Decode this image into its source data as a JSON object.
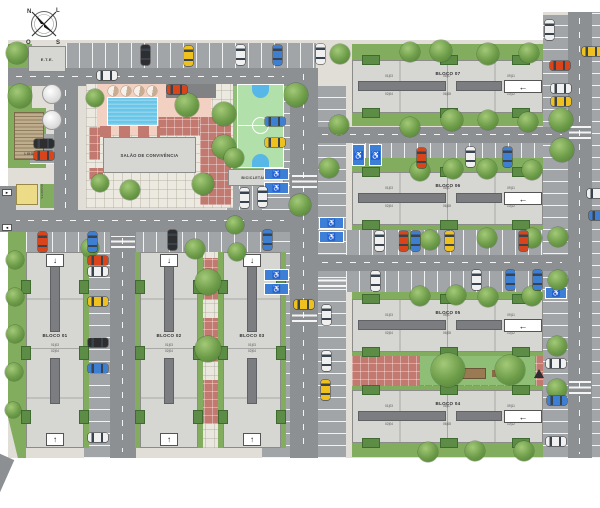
{
  "compass": {
    "n": "N",
    "e": "L",
    "s": "S",
    "w": "O"
  },
  "facilities": {
    "ete_label": "E.T.E.",
    "lixo_label": "LIXO",
    "guarita_label": "GUARITA",
    "salao_label": "SALÃO DE CONVIVÊNCIA",
    "bicicletario_label": "BICICLETÁRIO",
    "entry_arrow_in": "►",
    "entry_arrow_out": "◄"
  },
  "icons": {
    "accessible": "♿",
    "arrow_left": "←",
    "arrow_up": "↑",
    "arrow_down": "↓"
  },
  "blocks": [
    {
      "id": "bloco-01",
      "label": "BLOCO 01",
      "type": "vertical",
      "x": 26,
      "y": 252,
      "units_top": "01|03",
      "units_bottom": "02|04"
    },
    {
      "id": "bloco-02",
      "label": "BLOCO 02",
      "type": "vertical",
      "x": 140,
      "y": 252,
      "units_top": "01|03",
      "units_bottom": "02|04"
    },
    {
      "id": "bloco-03",
      "label": "BLOCO 03",
      "type": "vertical",
      "x": 223,
      "y": 252,
      "units_top": "01|03",
      "units_bottom": "02|04"
    },
    {
      "id": "bloco-07",
      "label": "BLOCO 07",
      "type": "horizontal",
      "x": 352,
      "y": 60,
      "gt": 16,
      "gb": 13,
      "units": {
        "lt": "01|03",
        "lb": "02|04",
        "mt": "05|07",
        "mb": "06|08",
        "rt": "09|11",
        "rb": "10|12"
      }
    },
    {
      "id": "bloco-06",
      "label": "BLOCO 06",
      "type": "horizontal",
      "x": 352,
      "y": 172,
      "gt": 14,
      "gb": 5,
      "units": {
        "lt": "01|03",
        "lb": "02|04",
        "mt": "05|07",
        "mb": "06|08",
        "rt": "09|11",
        "rb": "10|12"
      }
    },
    {
      "id": "bloco-05",
      "label": "BLOCO 05",
      "type": "horizontal",
      "x": 352,
      "y": 299,
      "gt": 7,
      "gb": 4,
      "units": {
        "lt": "01|03",
        "lb": "02|04",
        "mt": "05|07",
        "mb": "06|08",
        "rt": "09|11",
        "rb": "10|12"
      }
    },
    {
      "id": "bloco-04",
      "label": "BLOCO 04",
      "type": "horizontal",
      "x": 352,
      "y": 390,
      "gt": 4,
      "gb": 14,
      "units": {
        "lt": "01|03",
        "lb": "02|04",
        "mt": "05|07",
        "mb": "06|08",
        "rt": "09|11",
        "rb": "10|12"
      }
    }
  ],
  "cars": [
    [
      141,
      45,
      "v",
      "dark"
    ],
    [
      184,
      46,
      "v",
      "yellow"
    ],
    [
      236,
      45,
      "v",
      "white"
    ],
    [
      273,
      45,
      "v",
      "blue"
    ],
    [
      316,
      44,
      "v",
      "white"
    ],
    [
      97,
      71,
      "h",
      "white"
    ],
    [
      167,
      85,
      "h",
      "red"
    ],
    [
      34,
      139,
      "h",
      "dark"
    ],
    [
      34,
      151,
      "h",
      "red"
    ],
    [
      240,
      188,
      "v",
      "white"
    ],
    [
      258,
      187,
      "v",
      "white"
    ],
    [
      265,
      117,
      "h",
      "blue"
    ],
    [
      265,
      138,
      "h",
      "yellow"
    ],
    [
      294,
      300,
      "h",
      "yellow"
    ],
    [
      38,
      232,
      "v",
      "red"
    ],
    [
      88,
      232,
      "v",
      "blue"
    ],
    [
      168,
      230,
      "v",
      "dark"
    ],
    [
      263,
      230,
      "v",
      "blue"
    ],
    [
      88,
      256,
      "h",
      "red"
    ],
    [
      88,
      267,
      "h",
      "white"
    ],
    [
      88,
      297,
      "h",
      "yellow"
    ],
    [
      88,
      338,
      "h",
      "dark"
    ],
    [
      88,
      364,
      "h",
      "blue"
    ],
    [
      88,
      433,
      "h",
      "white"
    ],
    [
      417,
      148,
      "v",
      "red"
    ],
    [
      466,
      147,
      "v",
      "white"
    ],
    [
      503,
      147,
      "v",
      "blue"
    ],
    [
      375,
      231,
      "v",
      "white"
    ],
    [
      399,
      231,
      "v",
      "red"
    ],
    [
      411,
      231,
      "v",
      "blue"
    ],
    [
      445,
      231,
      "v",
      "yellow"
    ],
    [
      519,
      231,
      "v",
      "red"
    ],
    [
      371,
      271,
      "v",
      "white"
    ],
    [
      472,
      270,
      "v",
      "white"
    ],
    [
      506,
      270,
      "v",
      "blue"
    ],
    [
      533,
      270,
      "v",
      "blue"
    ],
    [
      322,
      305,
      "v",
      "white"
    ],
    [
      322,
      351,
      "v",
      "white"
    ],
    [
      321,
      380,
      "v",
      "yellow"
    ],
    [
      545,
      20,
      "v",
      "white"
    ],
    [
      582,
      47,
      "h",
      "yellow"
    ],
    [
      550,
      61,
      "h",
      "red"
    ],
    [
      551,
      84,
      "h",
      "white"
    ],
    [
      551,
      97,
      "h",
      "yellow"
    ],
    [
      546,
      359,
      "h",
      "white"
    ],
    [
      547,
      396,
      "h",
      "blue"
    ],
    [
      546,
      437,
      "h",
      "white"
    ],
    [
      587,
      189,
      "h",
      "white"
    ],
    [
      589,
      211,
      "h",
      "blue"
    ]
  ],
  "trees": [
    [
      17,
      53,
      11
    ],
    [
      20,
      96,
      12
    ],
    [
      15,
      260,
      9
    ],
    [
      15,
      297,
      9
    ],
    [
      15,
      334,
      9
    ],
    [
      14,
      372,
      9
    ],
    [
      13,
      410,
      8
    ],
    [
      95,
      98,
      9
    ],
    [
      100,
      183,
      9
    ],
    [
      130,
      190,
      10
    ],
    [
      90,
      248,
      9
    ],
    [
      187,
      105,
      12
    ],
    [
      224,
      114,
      12
    ],
    [
      224,
      147,
      12
    ],
    [
      203,
      184,
      11
    ],
    [
      296,
      95,
      12
    ],
    [
      234,
      158,
      10
    ],
    [
      300,
      205,
      11
    ],
    [
      235,
      225,
      9
    ],
    [
      195,
      249,
      10
    ],
    [
      237,
      252,
      9
    ],
    [
      339,
      125,
      10
    ],
    [
      329,
      168,
      10
    ],
    [
      340,
      54,
      10
    ],
    [
      410,
      52,
      10
    ],
    [
      441,
      51,
      11
    ],
    [
      488,
      54,
      11
    ],
    [
      529,
      53,
      10
    ],
    [
      410,
      127,
      10
    ],
    [
      452,
      120,
      11
    ],
    [
      488,
      120,
      10
    ],
    [
      528,
      122,
      10
    ],
    [
      420,
      171,
      10
    ],
    [
      453,
      169,
      10
    ],
    [
      487,
      169,
      10
    ],
    [
      532,
      170,
      10
    ],
    [
      409,
      240,
      9
    ],
    [
      430,
      240,
      10
    ],
    [
      487,
      238,
      10
    ],
    [
      532,
      238,
      10
    ],
    [
      420,
      296,
      10
    ],
    [
      456,
      295,
      10
    ],
    [
      488,
      297,
      10
    ],
    [
      532,
      296,
      10
    ],
    [
      448,
      370,
      17
    ],
    [
      510,
      370,
      15
    ],
    [
      428,
      452,
      10
    ],
    [
      475,
      451,
      10
    ],
    [
      524,
      451,
      10
    ],
    [
      561,
      120,
      12
    ],
    [
      562,
      150,
      12
    ],
    [
      558,
      237,
      10
    ],
    [
      558,
      280,
      10
    ],
    [
      557,
      346,
      10
    ],
    [
      557,
      389,
      10
    ],
    [
      208,
      282,
      13
    ],
    [
      208,
      349,
      13
    ]
  ],
  "accessible_spots": [
    [
      352,
      144,
      13,
      22
    ],
    [
      369,
      144,
      13,
      22
    ],
    [
      319,
      217,
      25,
      12
    ],
    [
      319,
      231,
      25,
      12
    ],
    [
      264,
      168,
      25,
      12
    ],
    [
      264,
      182,
      25,
      12
    ],
    [
      264,
      269,
      25,
      12
    ],
    [
      264,
      283,
      25,
      12
    ],
    [
      545,
      287,
      22,
      12
    ]
  ],
  "crosswalks": [
    [
      292,
      175,
      25,
      13
    ],
    [
      111,
      236,
      24,
      12
    ],
    [
      569,
      126,
      22,
      13
    ],
    [
      569,
      381,
      22,
      13
    ],
    [
      318,
      278,
      28,
      9
    ],
    [
      292,
      312,
      25,
      10
    ]
  ],
  "colors": {
    "road": "#8d9092",
    "parking": "#a2a5a7",
    "grass": "#83ad5e",
    "building": "#d6d6d3",
    "corridor": "#7b7d80",
    "pool": "#68c6e9",
    "court": "#b2e0aa",
    "court_key": "#57b7e6",
    "red_tile": "#c27a70",
    "accent_blue": "#3d7fd6",
    "car_red": "#d9441a",
    "car_yellow": "#eec11e",
    "car_blue": "#3f7fd2",
    "car_white": "#f0f0f0",
    "car_dark": "#2e2e30"
  }
}
